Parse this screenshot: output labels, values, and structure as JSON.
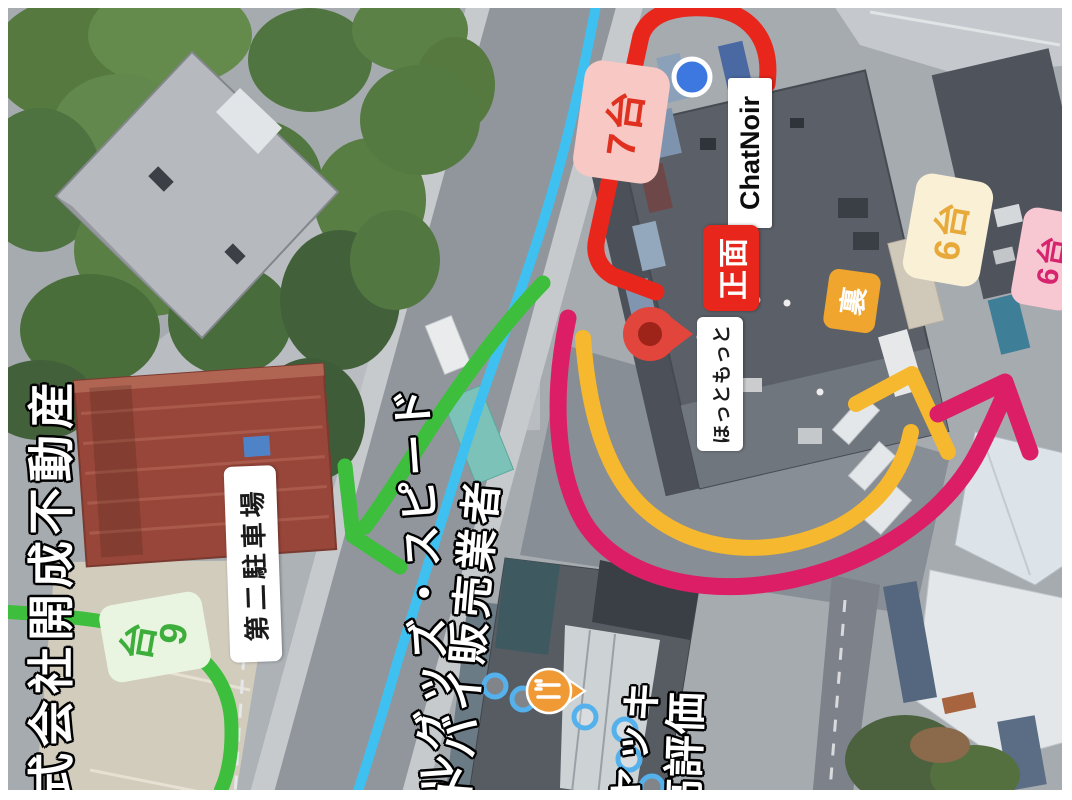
{
  "annotations": {
    "front_route_label": {
      "text": "7台",
      "bg": "#F7C8C4",
      "color": "#E0301F"
    },
    "store_label": {
      "text": "ChatNoir",
      "bg": "#FFFFFF",
      "color": "#0D0D0D"
    },
    "front_label": {
      "text": "正面",
      "bg": "#E8261B",
      "color": "#FFFFFF"
    },
    "hotto_motto_label": {
      "text": "ほっともっと",
      "bg": "#FFFFFF",
      "color": "#1C1C1C"
    },
    "back_label": {
      "text": "裏",
      "bg": "#F0A52E",
      "color": "#FFFFFF"
    },
    "back_count_yellow": {
      "text": "6台",
      "bg": "#FAF0D6",
      "color": "#E8A93B"
    },
    "back_count_pink": {
      "text": "6台",
      "bg": "#F8C8D2",
      "color": "#D6246E"
    },
    "second_lot_count": {
      "text": "9台",
      "bg": "#E9F5E1",
      "color": "#3DAE3C"
    },
    "second_lot_label": {
      "text": "第二駐車場",
      "bg": "#FFFFFF",
      "color": "#1A1A1A"
    },
    "route_colors": {
      "front_route": "#E8261B",
      "back_route_inner": "#F5B82E",
      "back_route_outer": "#DC1E66",
      "second_lot_route": "#3DBE3C",
      "road_line": "#3EC1F0"
    }
  },
  "map_texts": {
    "company": "式会社開成不動産",
    "goods_shop": "ルグッズ・スピード",
    "motorcycle_dealer": "トバイ販売業者",
    "restaurant_partial": "ャッキ",
    "rating": "高評価"
  },
  "icons": {
    "current_location": "blue-location-dot",
    "destination_pin": "red-map-pin",
    "restaurant_pin": "orange-fork-knife-pin",
    "walking_route": "blue-dotted-circles"
  }
}
